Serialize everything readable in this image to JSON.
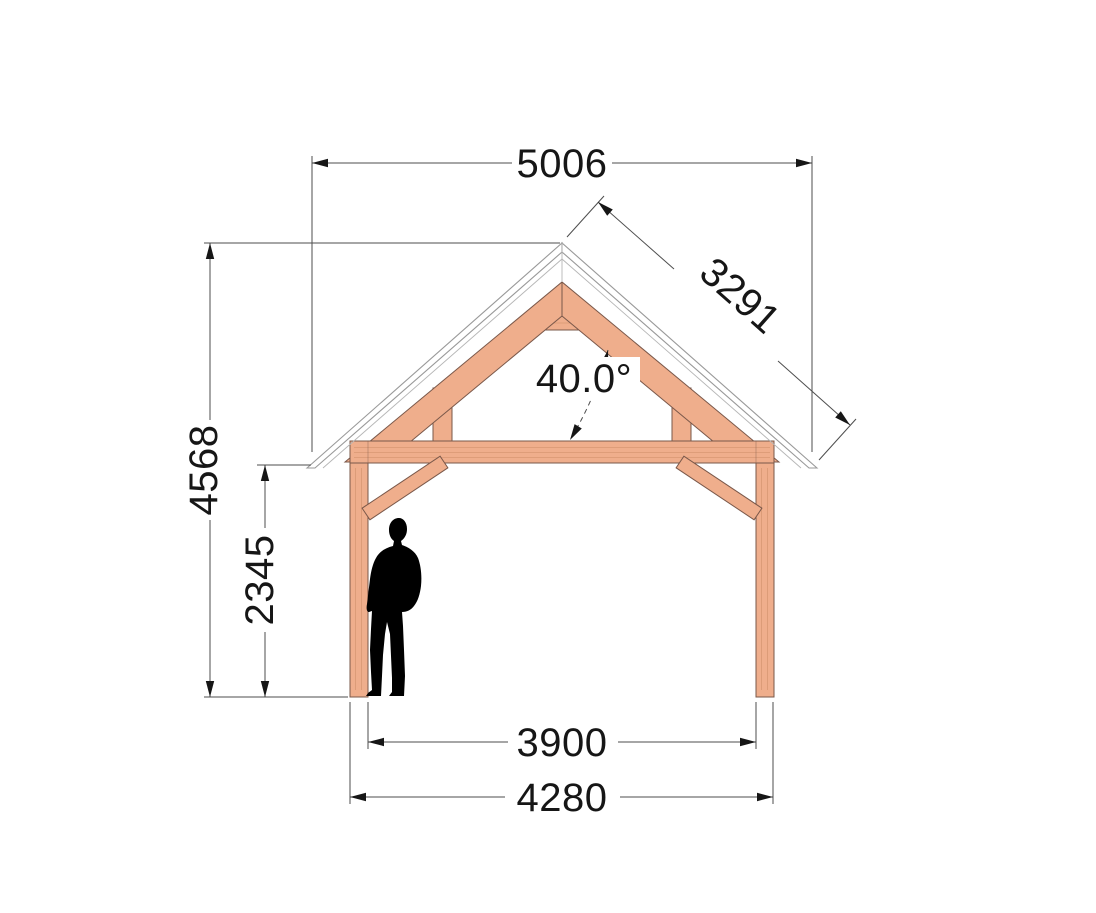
{
  "drawing": {
    "dimensions": {
      "roof_width": "5006",
      "rafter_length": "3291",
      "roof_angle": "40.0°",
      "total_height": "4568",
      "clearance_height": "2345",
      "inner_span": "3900",
      "outer_span": "4280"
    },
    "colors": {
      "wood": "#efae8c",
      "wood_outline": "#7a584a",
      "roof_outline": "#999999",
      "dimension_line": "#4d4d4d",
      "text": "#161616",
      "silhouette": "#000000",
      "background": "#ffffff"
    }
  }
}
